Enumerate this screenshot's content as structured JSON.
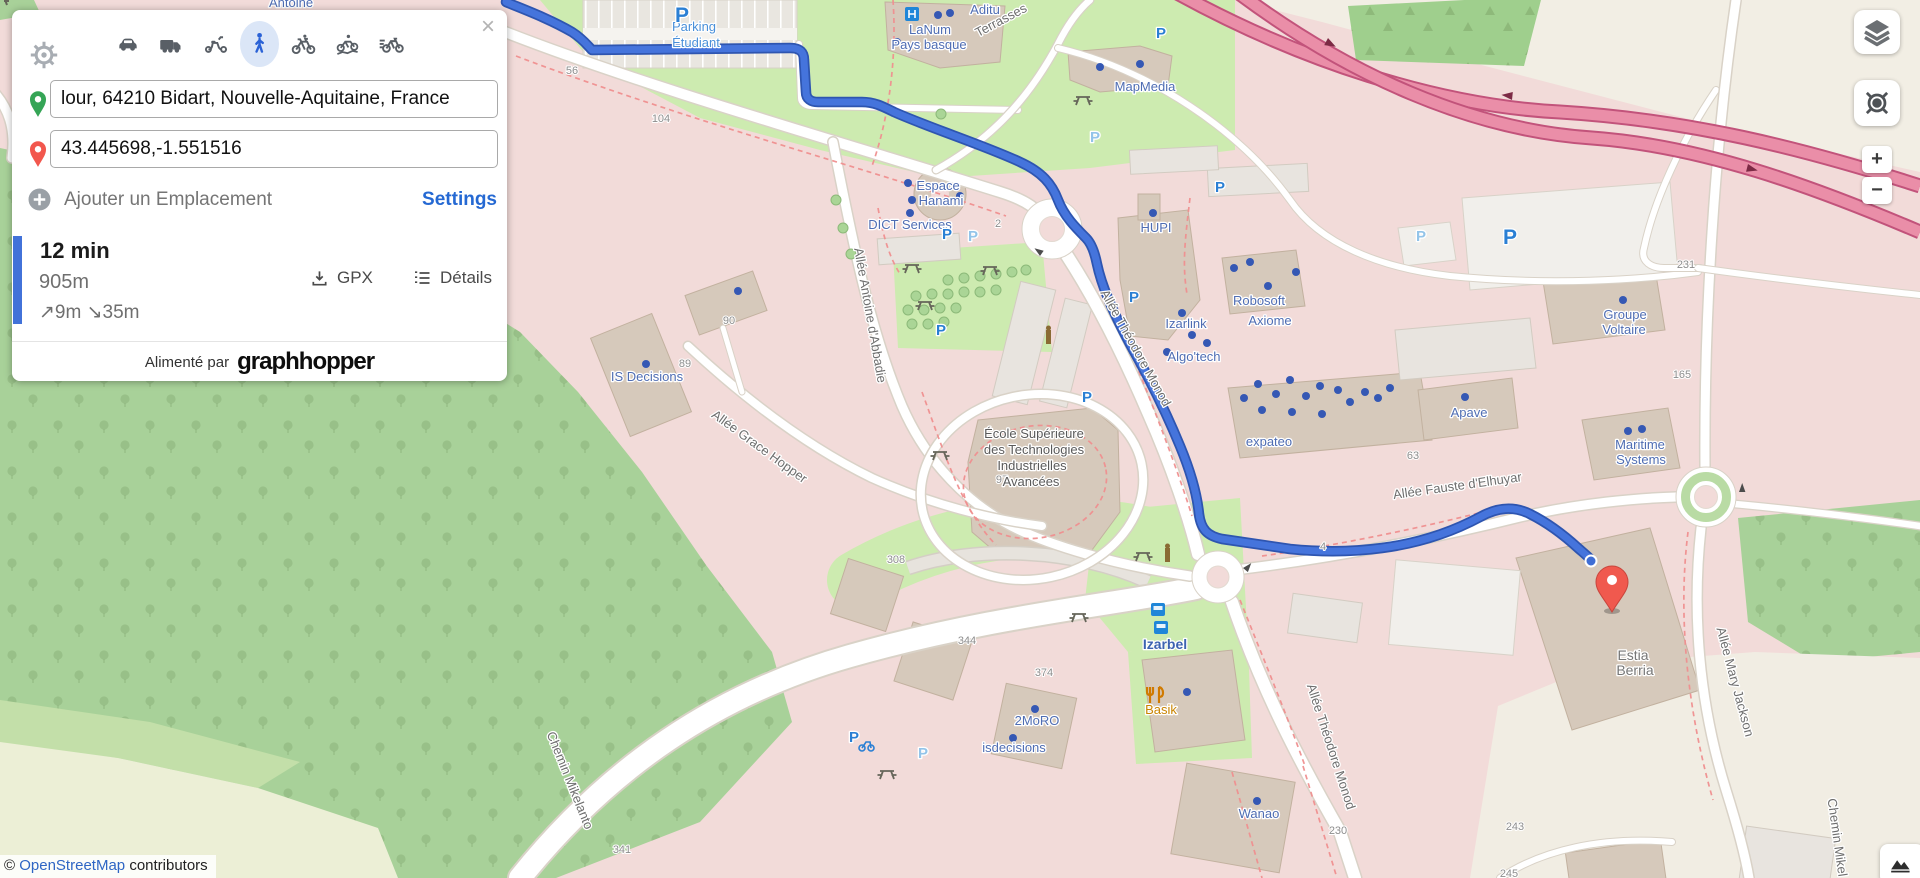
{
  "panel": {
    "close": "×",
    "modes": [
      {
        "name": "car",
        "selected": false
      },
      {
        "name": "truck",
        "selected": false
      },
      {
        "name": "scooter",
        "selected": false
      },
      {
        "name": "walking",
        "selected": true
      },
      {
        "name": "bike",
        "selected": false
      },
      {
        "name": "mountain-bike",
        "selected": false
      },
      {
        "name": "racing-bike",
        "selected": false
      }
    ],
    "from_value": "lour, 64210 Bidart, Nouvelle-Aquitaine, France",
    "to_value": "43.445698,-1.551516",
    "add_location": "Ajouter un Emplacement",
    "settings": "Settings",
    "route": {
      "duration": "12 min",
      "distance": "905m",
      "climb": "↗9m",
      "descent": "↘35m",
      "gpx": "GPX",
      "details": "Détails"
    },
    "powered_by": "Alimenté par",
    "brand": "graphhopper"
  },
  "controls": {
    "layers_icon": "layers-icon",
    "locate_icon": "locate-icon",
    "zoom_in": "+",
    "zoom_out": "−",
    "elevation_icon": "mountain-icon"
  },
  "attribution": {
    "copyright": "©",
    "link": "OpenStreetMap",
    "suffix": "contributors"
  },
  "map": {
    "colors": {
      "route": "#4574dc",
      "route_casing": "#2e55b0",
      "residential": "#f2dbd9",
      "forest": "#a8d199",
      "grass": "#cdebb0",
      "cream": "#f1ede3",
      "red_road": "#ea8ea8",
      "marker": "#f0594e",
      "parking_blue": "#2a7fd4",
      "poi_blue": "#4f6db3",
      "link_blue": "#2f66c4"
    },
    "labels": [
      {
        "t": "Antoine",
        "x": 291,
        "y": 7,
        "r": 0,
        "k": "poi"
      },
      {
        "t": "Terrasses",
        "x": 1003,
        "y": 24,
        "r": -28,
        "k": "st"
      },
      {
        "t": "Allée Antoine d'Abbadie",
        "x": 866,
        "y": 316,
        "r": 80,
        "k": "st"
      },
      {
        "t": "Allée Grace Hopper",
        "x": 757,
        "y": 450,
        "r": 36,
        "k": "st"
      },
      {
        "t": "Allée Théodore Monod",
        "x": 1132,
        "y": 350,
        "r": 61,
        "k": "st"
      },
      {
        "t": "Allée Théodore Monod",
        "x": 1327,
        "y": 748,
        "r": 72,
        "k": "st"
      },
      {
        "t": "Allée Fauste d'Elhuyar",
        "x": 1458,
        "y": 490,
        "r": -8,
        "k": "st"
      },
      {
        "t": "Allée Mary Jackson",
        "x": 1731,
        "y": 683,
        "r": 75,
        "k": "st"
      },
      {
        "t": "Chemin Mikelanto",
        "x": 566,
        "y": 782,
        "r": 68,
        "k": "st"
      },
      {
        "t": "Chemin Mikel",
        "x": 1833,
        "y": 838,
        "r": 82,
        "k": "st"
      },
      {
        "t": "56",
        "x": 572,
        "y": 74,
        "r": 0,
        "k": "num"
      },
      {
        "t": "104",
        "x": 661,
        "y": 122,
        "r": 0,
        "k": "num"
      },
      {
        "t": "2",
        "x": 998,
        "y": 227,
        "r": 0,
        "k": "num"
      },
      {
        "t": "90",
        "x": 729,
        "y": 324,
        "r": 0,
        "k": "num"
      },
      {
        "t": "89",
        "x": 685,
        "y": 367,
        "r": 0,
        "k": "num"
      },
      {
        "t": "97",
        "x": 1002,
        "y": 483,
        "r": 0,
        "k": "num"
      },
      {
        "t": "4",
        "x": 1323,
        "y": 550,
        "r": 0,
        "k": "num"
      },
      {
        "t": "308",
        "x": 896,
        "y": 563,
        "r": 0,
        "k": "num"
      },
      {
        "t": "344",
        "x": 967,
        "y": 644,
        "r": 0,
        "k": "num"
      },
      {
        "t": "374",
        "x": 1044,
        "y": 676,
        "r": 0,
        "k": "num"
      },
      {
        "t": "341",
        "x": 622,
        "y": 853,
        "r": 0,
        "k": "num"
      },
      {
        "t": "230",
        "x": 1338,
        "y": 834,
        "r": 0,
        "k": "num"
      },
      {
        "t": "243",
        "x": 1515,
        "y": 830,
        "r": 0,
        "k": "num"
      },
      {
        "t": "245",
        "x": 1509,
        "y": 877,
        "r": 0,
        "k": "num"
      },
      {
        "t": "231",
        "x": 1686,
        "y": 268,
        "r": 0,
        "k": "num"
      },
      {
        "t": "165",
        "x": 1682,
        "y": 378,
        "r": 0,
        "k": "num"
      },
      {
        "t": "63",
        "x": 1413,
        "y": 459,
        "r": 0,
        "k": "num"
      },
      {
        "t": "Parking",
        "x": 694,
        "y": 31,
        "r": 0,
        "k": "pb"
      },
      {
        "t": "Étudiant",
        "x": 696,
        "y": 47,
        "r": 0,
        "k": "pb"
      },
      {
        "t": "LaNum",
        "x": 930,
        "y": 34,
        "r": 0,
        "k": "poi"
      },
      {
        "t": "Pays basque",
        "x": 929,
        "y": 49,
        "r": 0,
        "k": "poi"
      },
      {
        "t": "Aditu",
        "x": 985,
        "y": 14,
        "r": 0,
        "k": "poi"
      },
      {
        "t": "MapMedia",
        "x": 1145,
        "y": 91,
        "r": 0,
        "k": "poi"
      },
      {
        "t": "Espace",
        "x": 938,
        "y": 190,
        "r": 0,
        "k": "poi"
      },
      {
        "t": "Hanami",
        "x": 941,
        "y": 205,
        "r": 0,
        "k": "poi"
      },
      {
        "t": "DICT Services",
        "x": 910,
        "y": 229,
        "r": 0,
        "k": "poi"
      },
      {
        "t": "HUPI",
        "x": 1156,
        "y": 232,
        "r": 0,
        "k": "poi"
      },
      {
        "t": "Robosoft",
        "x": 1259,
        "y": 305,
        "r": 0,
        "k": "poi"
      },
      {
        "t": "Izarlink",
        "x": 1186,
        "y": 328,
        "r": 0,
        "k": "poi"
      },
      {
        "t": "Axiome",
        "x": 1270,
        "y": 325,
        "r": 0,
        "k": "poi"
      },
      {
        "t": "Algo'tech",
        "x": 1194,
        "y": 361,
        "r": 0,
        "k": "poi"
      },
      {
        "t": "expateo",
        "x": 1269,
        "y": 446,
        "r": 0,
        "k": "poi"
      },
      {
        "t": "IS Decisions",
        "x": 647,
        "y": 381,
        "r": 0,
        "k": "poi"
      },
      {
        "t": "Izarbel",
        "x": 1165,
        "y": 649,
        "r": 0,
        "k": "poib"
      },
      {
        "t": "2MoRO",
        "x": 1037,
        "y": 725,
        "r": 0,
        "k": "poi"
      },
      {
        "t": "isdecisions",
        "x": 1014,
        "y": 752,
        "r": 0,
        "k": "poi"
      },
      {
        "t": "Wanao",
        "x": 1259,
        "y": 818,
        "r": 0,
        "k": "poi"
      },
      {
        "t": "Groupe",
        "x": 1625,
        "y": 319,
        "r": 0,
        "k": "poi"
      },
      {
        "t": "Voltaire",
        "x": 1624,
        "y": 334,
        "r": 0,
        "k": "poi"
      },
      {
        "t": "Apave",
        "x": 1469,
        "y": 417,
        "r": 0,
        "k": "poi"
      },
      {
        "t": "Maritime",
        "x": 1640,
        "y": 449,
        "r": 0,
        "k": "poi"
      },
      {
        "t": "Systems",
        "x": 1641,
        "y": 464,
        "r": 0,
        "k": "poi"
      },
      {
        "t": "Basik",
        "x": 1161,
        "y": 714,
        "r": 0,
        "k": "org"
      },
      {
        "t": "Estia",
        "x": 1633,
        "y": 660,
        "r": 0,
        "k": "gry"
      },
      {
        "t": "Berria",
        "x": 1635,
        "y": 675,
        "r": 0,
        "k": "gry"
      },
      {
        "t": "École Supérieure",
        "x": 1034,
        "y": 438,
        "r": 0,
        "k": "gryd"
      },
      {
        "t": "des Technologies",
        "x": 1034,
        "y": 454,
        "r": 0,
        "k": "gryd"
      },
      {
        "t": "Industrielles",
        "x": 1032,
        "y": 470,
        "r": 0,
        "k": "gryd"
      },
      {
        "t": "Avancées",
        "x": 1031,
        "y": 486,
        "r": 0,
        "k": "gryd"
      },
      {
        "t": "P",
        "x": 682,
        "y": 22,
        "r": 0,
        "k": "pkB"
      },
      {
        "t": "P",
        "x": 947,
        "y": 239,
        "r": 0,
        "k": "pk"
      },
      {
        "t": "P",
        "x": 1134,
        "y": 302,
        "r": 0,
        "k": "pk"
      },
      {
        "t": "P",
        "x": 1087,
        "y": 402,
        "r": 0,
        "k": "pk"
      },
      {
        "t": "P",
        "x": 1220,
        "y": 192,
        "r": 0,
        "k": "pk"
      },
      {
        "t": "P",
        "x": 1161,
        "y": 38,
        "r": 0,
        "k": "pk"
      },
      {
        "t": "P",
        "x": 941,
        "y": 335,
        "r": 0,
        "k": "pk"
      },
      {
        "t": "P",
        "x": 854,
        "y": 742,
        "r": 0,
        "k": "pk"
      },
      {
        "t": "P",
        "x": 1510,
        "y": 244,
        "r": 0,
        "k": "pkB"
      },
      {
        "t": "P",
        "x": 1095,
        "y": 142,
        "r": 0,
        "k": "pkl"
      },
      {
        "t": "P",
        "x": 973,
        "y": 241,
        "r": 0,
        "k": "pkl"
      },
      {
        "t": "P",
        "x": 1421,
        "y": 241,
        "r": 0,
        "k": "pkl"
      },
      {
        "t": "P",
        "x": 923,
        "y": 758,
        "r": 0,
        "k": "pkl"
      }
    ]
  }
}
